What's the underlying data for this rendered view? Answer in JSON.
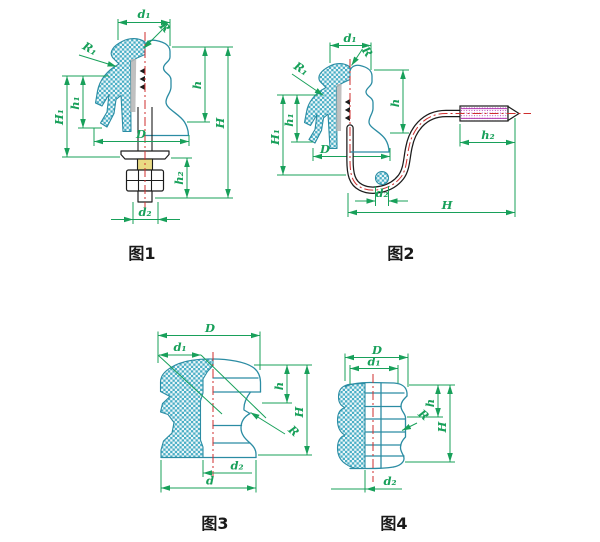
{
  "title": "insulator-dimension-drawings",
  "colors": {
    "dimension": "#18a05a",
    "outline": "#2b8ca3",
    "hatch": "#49aec5",
    "hatch_bg": "#eef7f9",
    "centerline": "#cf2e2e",
    "hardware": "#1c1c1c",
    "thread": "#b23ab2",
    "brass": "#e9da83",
    "caption": "#1a1a1a"
  },
  "figures": [
    {
      "caption": "图1",
      "labels": {
        "d1": "d₁",
        "R": "R",
        "R1": "R₁",
        "h1": "h₁",
        "H1": "H₁",
        "h": "h",
        "H": "H",
        "D": "D",
        "h2": "h₂",
        "d2": "d₂"
      }
    },
    {
      "caption": "图2",
      "labels": {
        "d1": "d₁",
        "R": "R",
        "R1": "R₁",
        "h1": "h₁",
        "H1": "H₁",
        "h": "h",
        "D": "D",
        "h2": "h₂",
        "H": "H",
        "d2": "d₂"
      }
    },
    {
      "caption": "图3",
      "labels": {
        "D": "D",
        "d1": "d₁",
        "h": "h",
        "H": "H",
        "R": "R",
        "d2": "d₂",
        "d": "d"
      }
    },
    {
      "caption": "图4",
      "labels": {
        "D": "D",
        "d1": "d₁",
        "h": "h",
        "R": "R",
        "H": "H",
        "d2": "d₂"
      }
    }
  ]
}
